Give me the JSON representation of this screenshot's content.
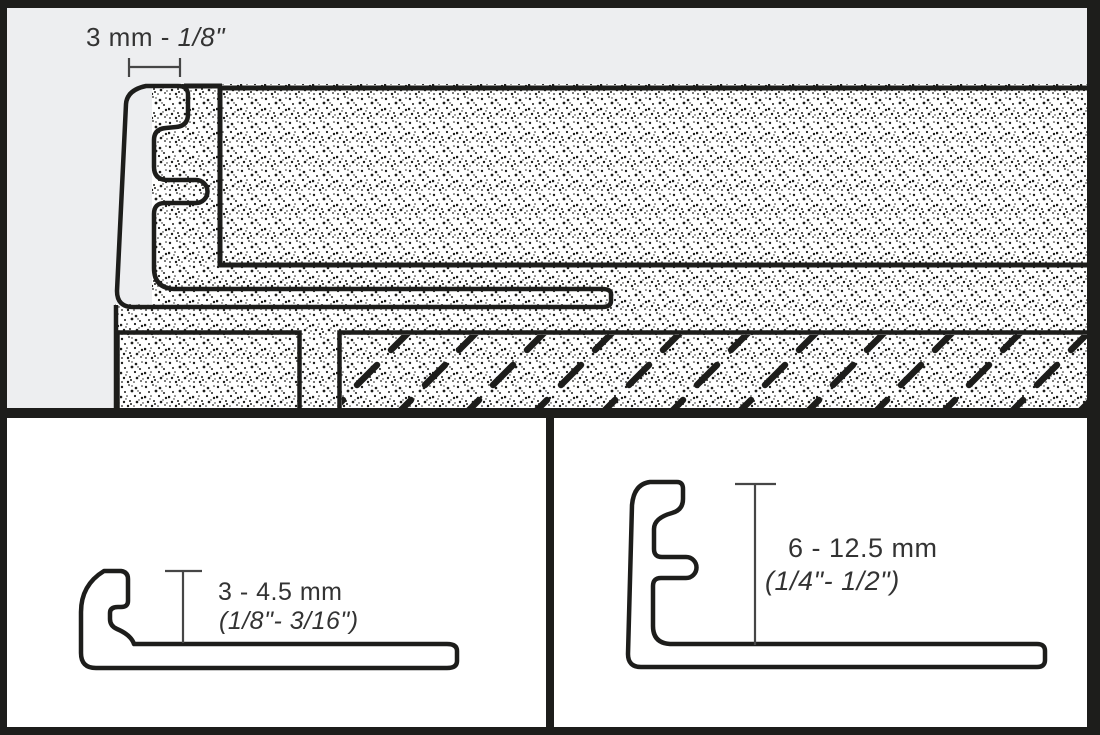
{
  "drawing_title": "tile-edge-profile-installation-diagram",
  "colors": {
    "profile_orange": "#F5A137",
    "tile_gray": "#A8AAAD",
    "background_gray": "#EDEEF0",
    "panel_white": "#FFFFFF",
    "outline_black": "#1D1D1B",
    "text_dark": "#333333"
  },
  "top_panel": {
    "dimension_metric": "3 mm",
    "dimension_separator": " - ",
    "dimension_imperial": "1/8\""
  },
  "bottom_left_panel": {
    "height_metric": "3 - 4.5 mm",
    "height_imperial": "(1/8\"- 3/16\")"
  },
  "bottom_right_panel": {
    "height_metric": "6 - 12.5 mm",
    "height_imperial": "(1/4\"- 1/2\")"
  }
}
